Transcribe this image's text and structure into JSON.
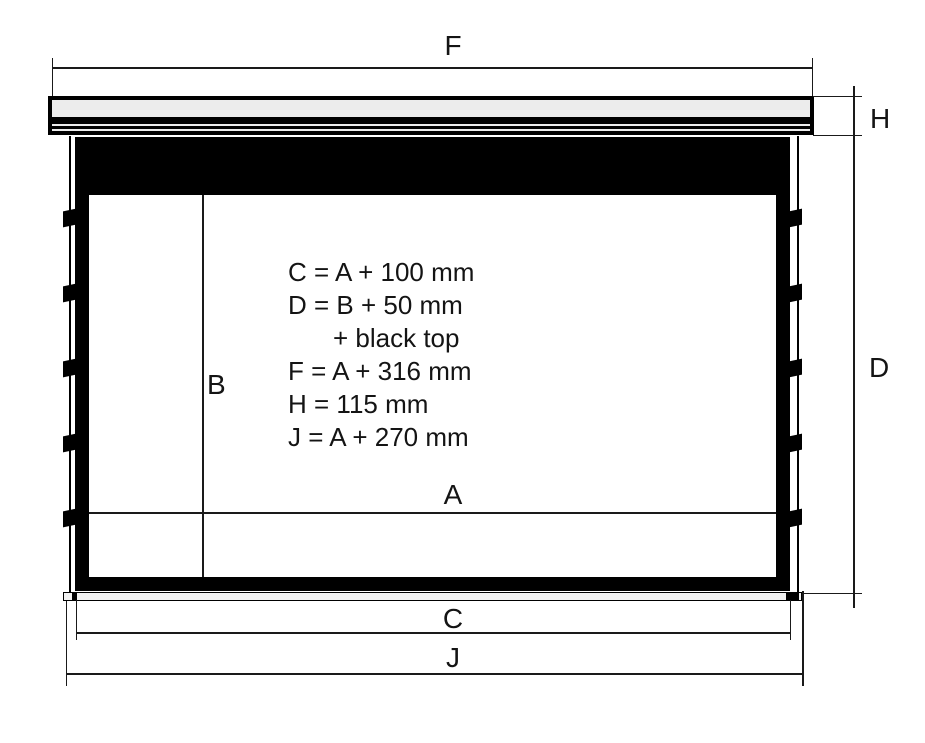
{
  "dimension_labels": {
    "F": "F",
    "H": "H",
    "D": "D",
    "B": "B",
    "A": "A",
    "C": "C",
    "J": "J"
  },
  "formulas": {
    "lines": [
      "C = A + 100 mm",
      "D = B + 50 mm",
      "+ black top",
      "F = A + 316 mm",
      "H = 115 mm",
      "J = A + 270 mm"
    ]
  },
  "colors": {
    "ink": "#141414",
    "line": "#1a1a1a",
    "screen_black": "#000000",
    "casing_fill": "#ececec",
    "slat_fill": "#f1f1f1",
    "background": "#ffffff"
  }
}
